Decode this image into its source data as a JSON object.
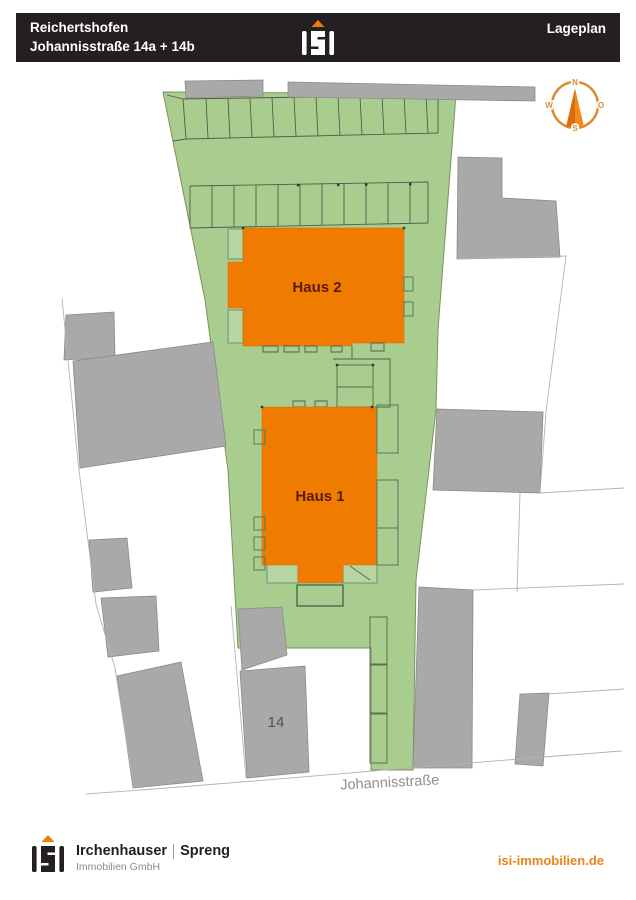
{
  "header": {
    "location_line1": "Reichertshofen",
    "location_line2": "Johannisstraße 14a + 14b",
    "title": "Lageplan"
  },
  "plan": {
    "haus1_label": "Haus 1",
    "haus2_label": "Haus 2",
    "neighbor_house_number": "14",
    "street_name": "Johannisstraße"
  },
  "compass": {
    "north": "N",
    "east": "O",
    "south": "S",
    "west": "W"
  },
  "footer": {
    "company_name_left": "Irchenhauser",
    "company_name_right": "Spreng",
    "company_subtitle": "Immobilien GmbH",
    "website": "isi-immobilien.de"
  },
  "icons": {
    "logo": "isi-house-logo",
    "compass": "compass-rose"
  },
  "colors": {
    "accent_orange": "#ef7c00",
    "parcel_green": "#a9cd8e",
    "building_gray": "#a9a9a9",
    "header_black": "#242021",
    "label_dark_red": "#5e1a0e",
    "compass_orange": "#dd8a33"
  }
}
